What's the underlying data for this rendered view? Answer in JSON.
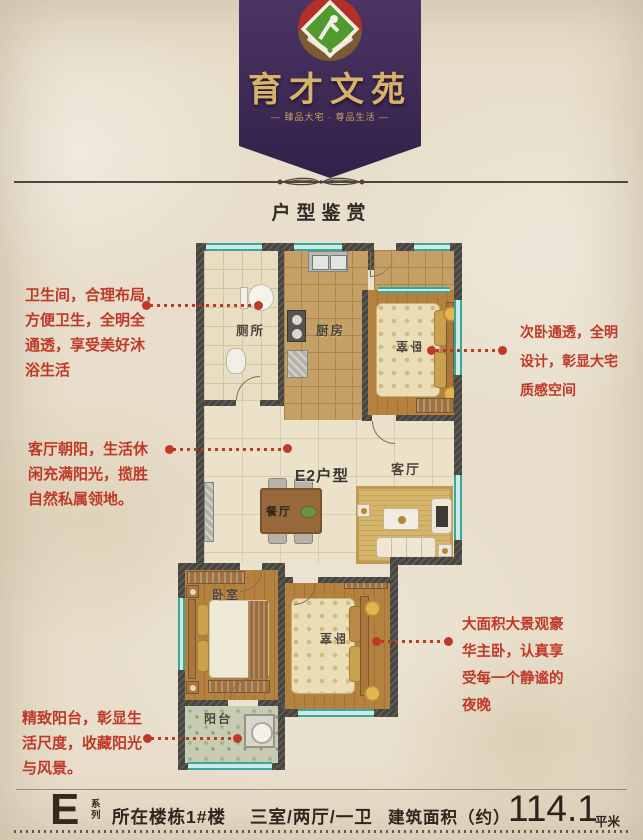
{
  "colors": {
    "accent_red": "#c03928",
    "banner_purple": "#3d2a55",
    "gold": "#d8b26a",
    "wall": "#46443e",
    "window_teal": "#3aa79b",
    "paper": "#e8decb"
  },
  "banner": {
    "title": "育才文苑",
    "tagline": "— 臻品大宅 · 尊品生活 —"
  },
  "section": {
    "heading": "户型鉴赏"
  },
  "plan": {
    "unit_label": "E2户型",
    "rooms": {
      "bathroom": "厕所",
      "kitchen": "厨房",
      "bedroom_top": "卧室",
      "living": "客厅",
      "dining": "餐厅",
      "bedroom_left": "卧室",
      "bedroom_master": "卧室",
      "balcony": "阳台"
    }
  },
  "annotations": {
    "left": [
      {
        "text": "卫生间，合理布局，\n方便卫生，全明全\n通透，享受美好沐\n浴生活"
      },
      {
        "text": "客厅朝阳，生活休\n闲充满阳光，揽胜\n自然私属领地。"
      },
      {
        "text": "精致阳台，彰显生\n活尺度，收藏阳光\n与风景。"
      }
    ],
    "right": [
      {
        "text": "次卧通透，全明\n设计，彰显大宅\n质感空间"
      },
      {
        "text": "大面积大景观豪\n华主卧，认真享\n受每一个静谧的\n夜晚"
      }
    ]
  },
  "footer": {
    "series_letter": "E",
    "series_label_top": "系",
    "series_label_bottom": "列",
    "building": "所在楼栋1#楼",
    "layout": "三室/两厅/一卫",
    "area_label": "建筑面积（约）",
    "area_value": "114.1",
    "area_unit": "平米"
  }
}
